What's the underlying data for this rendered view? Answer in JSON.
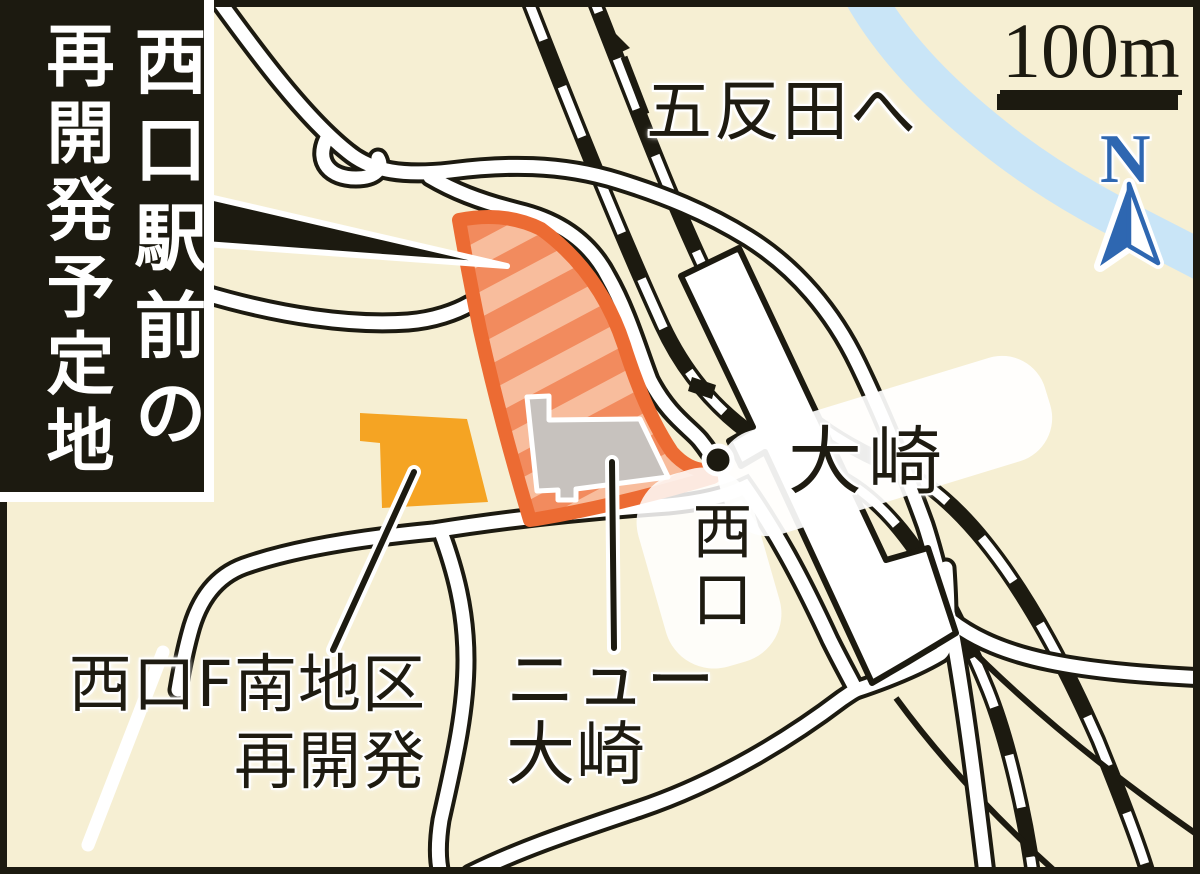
{
  "canvas": {
    "width": 1200,
    "height": 874,
    "background_color": "#F6EFD3",
    "frame_color": "#1C1A10"
  },
  "title": {
    "line1": "西口駅前の",
    "line2": "再開発予定地",
    "background_color": "#1C1A10",
    "text_color": "#FFFFFF"
  },
  "map_labels": {
    "to_gotanda": "五反田へ",
    "osaki_station": "大崎",
    "west_exit": "西口",
    "new_osaki_line1": "ニュー",
    "new_osaki_line2": "大崎",
    "west_f_district_line1": "西口F南地区",
    "west_f_district_line2": "再開発"
  },
  "scale_bar": {
    "label": "100m"
  },
  "compass": {
    "label": "N",
    "color": "#2E67B1"
  },
  "colors": {
    "redevelopment_site_border": "#EC6B33",
    "redevelopment_site_stripe_dark": "#F28B5E",
    "redevelopment_site_stripe_light": "#F8BD9D",
    "orange_building": "#F5A423",
    "gray_building": "#C7C2BE",
    "river": "#C9E5F7",
    "road_fill": "#FFFFFF",
    "road_casing": "#1C1A10",
    "railway": "#1C1A10",
    "station_building": "#FFFFFF"
  }
}
